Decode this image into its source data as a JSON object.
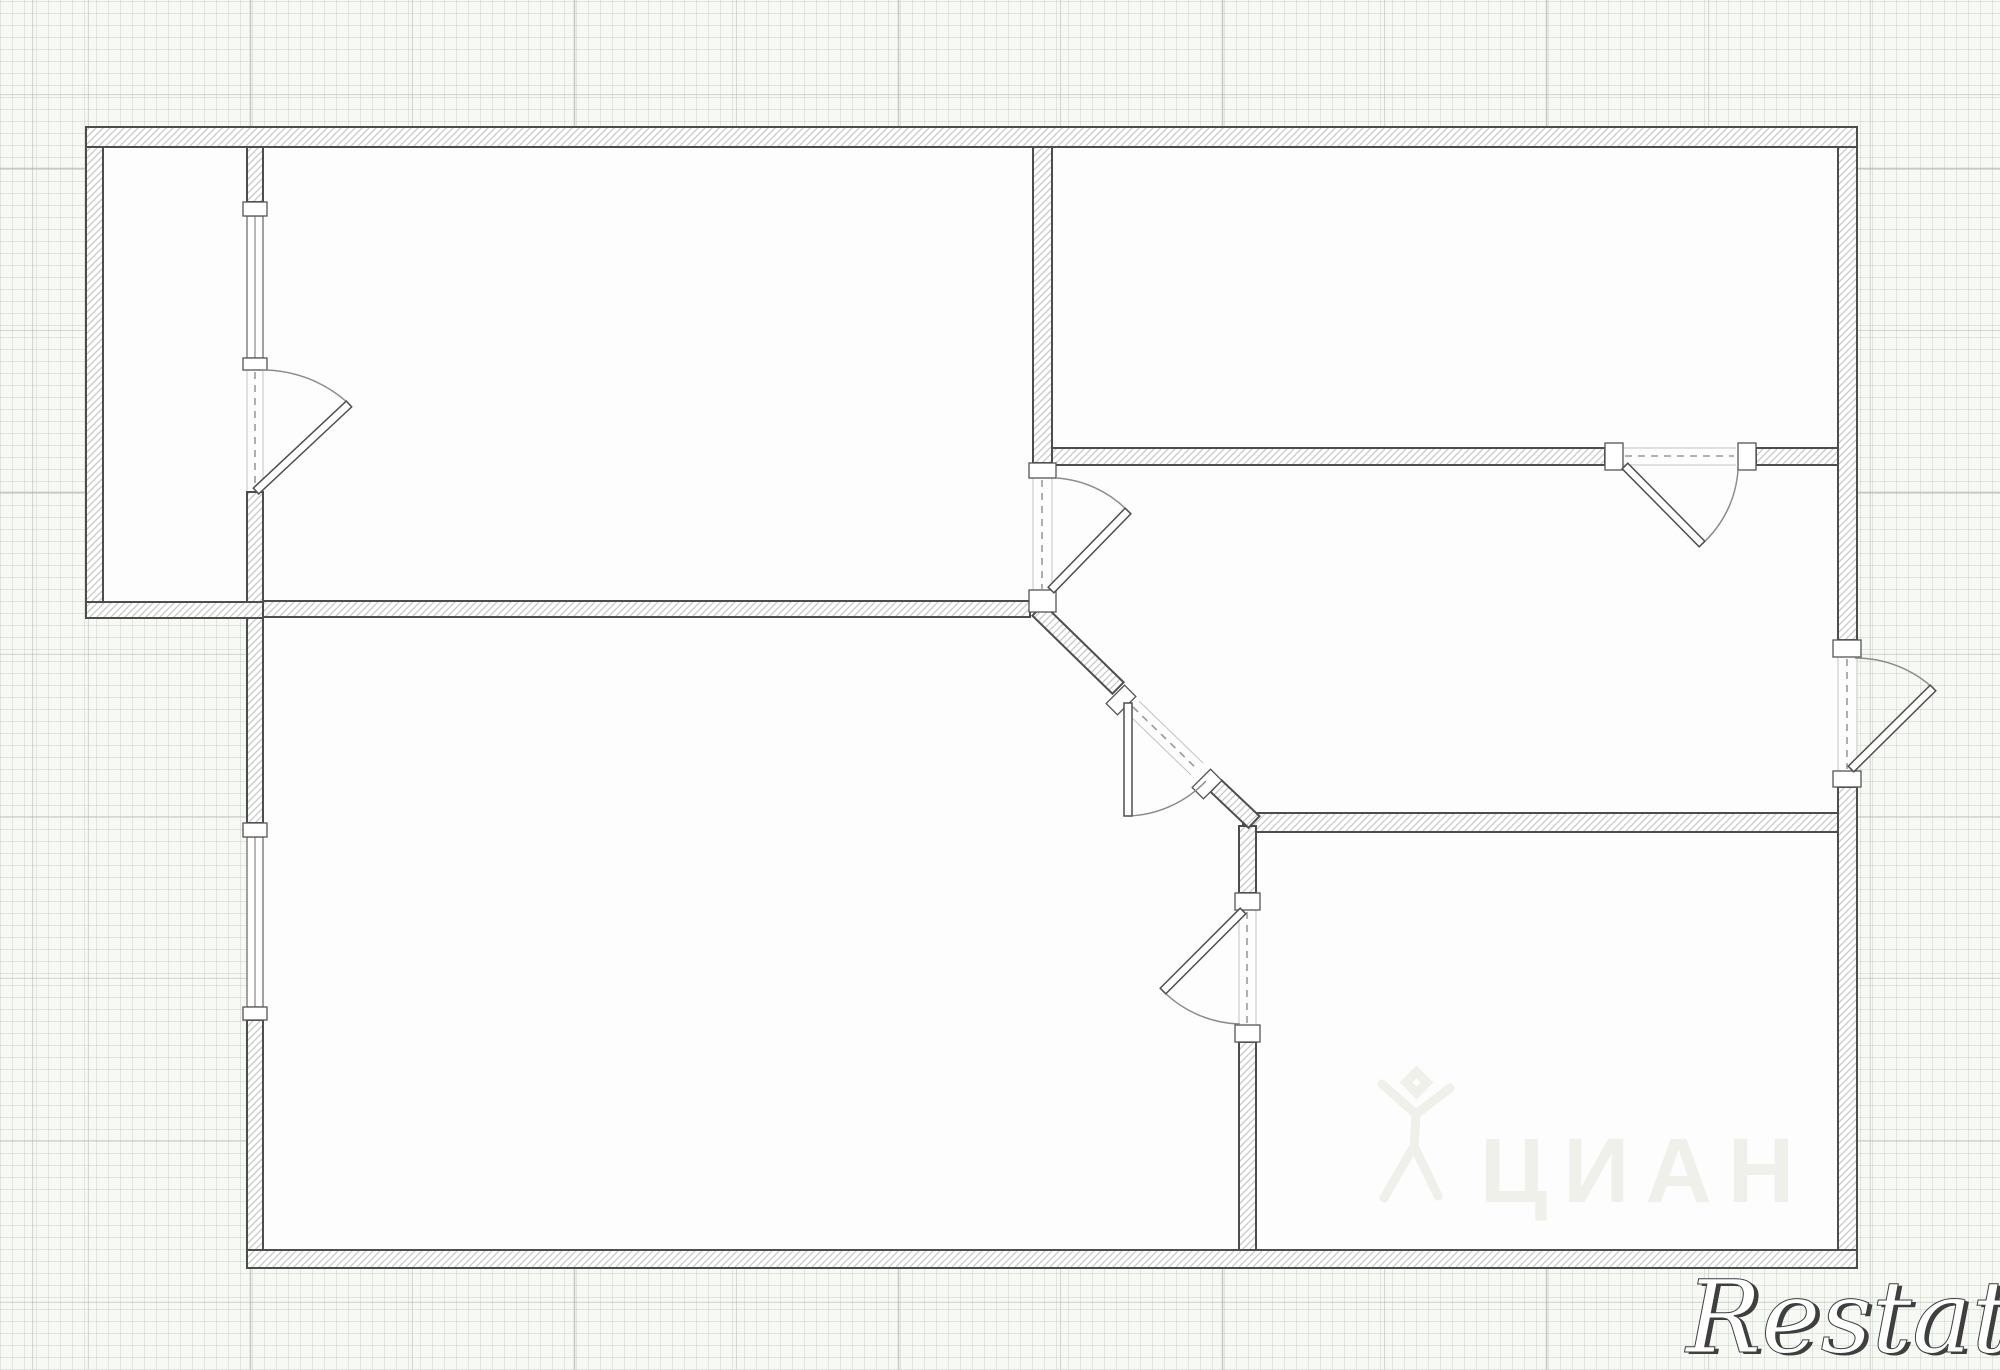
{
  "canvas": {
    "width": 2000,
    "height": 1370
  },
  "watermarks": {
    "cian_text": "ЦИАН",
    "restate_text": "Restate"
  },
  "colors": {
    "floor": "#fdfdfd",
    "wall_stroke": "#4d4d4d",
    "hatch_line": "#c9c9c9",
    "hatch_bg": "#ffffff",
    "jamb_stroke": "#555555",
    "window_stroke": "#6f6f6f",
    "opening_edge": "#c4c4c4",
    "opening_dash": "#9a9a9a",
    "door_arc": "#8c8c8c",
    "door_leaf_fill": "#ffffff",
    "door_leaf_stroke": "#4f4f4f",
    "cian_watermark": "#f0f0ea",
    "restate_fill": "#ffffff",
    "restate_outline": "#3f3f3f"
  },
  "grid": {
    "bg": "#f7f9f5",
    "minor_step": 12,
    "minor_color": "rgba(186,196,186,0.38)",
    "major_step": 162,
    "major_color": "rgba(158,164,158,0.55)",
    "major_offset_x": 88,
    "major_offset_y": 95
  },
  "floorplan": {
    "outline": [
      [
        86,
        127
      ],
      [
        1857,
        127
      ],
      [
        1857,
        1268
      ],
      [
        247,
        1268
      ],
      [
        247,
        618
      ],
      [
        86,
        618
      ]
    ],
    "walls": [
      {
        "name": "top-exterior-wall",
        "x": 86,
        "y": 127,
        "w": 1771,
        "h": 20
      },
      {
        "name": "left-upper-exterior-wall",
        "x": 86,
        "y": 147,
        "w": 17,
        "h": 455
      },
      {
        "name": "balcony-bottom-wall",
        "x": 86,
        "y": 602,
        "w": 177,
        "h": 16
      },
      {
        "name": "balcony-partition-stub",
        "x": 247,
        "y": 147,
        "w": 16,
        "h": 55
      },
      {
        "name": "balcony-partition-lower",
        "x": 247,
        "y": 492,
        "w": 16,
        "h": 110
      },
      {
        "name": "livingroom-bottom-wall",
        "x": 263,
        "y": 601,
        "w": 767,
        "h": 16
      },
      {
        "name": "center-vertical-wall",
        "x": 1033,
        "y": 147,
        "w": 19,
        "h": 316
      },
      {
        "name": "topright-bottom-wall-left",
        "x": 1052,
        "y": 448,
        "w": 553,
        "h": 17
      },
      {
        "name": "topright-bottom-wall-right",
        "x": 1756,
        "y": 448,
        "w": 82,
        "h": 17
      },
      {
        "name": "right-exterior-wall-upper",
        "x": 1838,
        "y": 147,
        "w": 19,
        "h": 493
      },
      {
        "name": "right-exterior-wall-lower",
        "x": 1838,
        "y": 787,
        "w": 19,
        "h": 463
      },
      {
        "name": "midright-bottom-wall",
        "x": 1243,
        "y": 813,
        "w": 595,
        "h": 19
      },
      {
        "name": "bottomcenter-wall-upper",
        "x": 1239,
        "y": 826,
        "w": 17,
        "h": 67
      },
      {
        "name": "bottomcenter-wall-lower",
        "x": 1239,
        "y": 1042,
        "w": 17,
        "h": 208
      },
      {
        "name": "left-lower-exterior-wall-a",
        "x": 247,
        "y": 618,
        "w": 16,
        "h": 205
      },
      {
        "name": "left-lower-exterior-wall-b",
        "x": 247,
        "y": 1020,
        "w": 16,
        "h": 230
      },
      {
        "name": "bottom-exterior-wall",
        "x": 247,
        "y": 1250,
        "w": 1610,
        "h": 18
      }
    ],
    "diag_walls": [
      {
        "name": "diagonal-wall-a",
        "x1": 1038,
        "y1": 610,
        "x2": 1118,
        "y2": 688,
        "thick": 16
      },
      {
        "name": "diagonal-wall-b",
        "x1": 1216,
        "y1": 786,
        "x2": 1254,
        "y2": 822,
        "thick": 16
      }
    ],
    "jambs": [
      {
        "x": 243,
        "y": 202,
        "w": 24,
        "h": 14,
        "angle": 0
      },
      {
        "x": 243,
        "y": 358,
        "w": 24,
        "h": 12,
        "angle": 0
      },
      {
        "x": 243,
        "y": 823,
        "w": 24,
        "h": 14,
        "angle": 0
      },
      {
        "x": 243,
        "y": 1007,
        "w": 24,
        "h": 13,
        "angle": 0
      },
      {
        "x": 1029,
        "y": 463,
        "w": 27,
        "h": 15,
        "angle": 0
      },
      {
        "x": 1029,
        "y": 590,
        "w": 27,
        "h": 22,
        "angle": 0
      },
      {
        "x": 1605,
        "y": 443,
        "w": 18,
        "h": 27,
        "angle": 0
      },
      {
        "x": 1738,
        "y": 443,
        "w": 18,
        "h": 27,
        "angle": 0
      },
      {
        "x": 1833,
        "y": 640,
        "w": 28,
        "h": 17,
        "angle": 0
      },
      {
        "x": 1833,
        "y": 771,
        "w": 28,
        "h": 16,
        "angle": 0
      },
      {
        "x": 1235,
        "y": 893,
        "w": 25,
        "h": 17,
        "angle": 0
      },
      {
        "x": 1235,
        "y": 1025,
        "w": 25,
        "h": 17,
        "angle": 0
      },
      {
        "x": 1113,
        "y": 687,
        "w": 16,
        "h": 26,
        "angle": 45
      },
      {
        "x": 1199,
        "y": 771,
        "w": 16,
        "h": 26,
        "angle": 45
      }
    ],
    "windows": [
      {
        "name": "balcony-window",
        "x": 247,
        "y": 216,
        "w": 16,
        "h": 142
      },
      {
        "name": "bottomleft-window",
        "x": 247,
        "y": 837,
        "w": 16,
        "h": 170
      }
    ],
    "open_edges": [
      [
        247,
        370,
        247,
        491
      ],
      [
        263,
        370,
        263,
        491
      ],
      [
        1033,
        478,
        1033,
        590
      ],
      [
        1052,
        478,
        1052,
        590
      ],
      [
        1623,
        448,
        1736,
        448
      ],
      [
        1623,
        465,
        1736,
        465
      ],
      [
        1838,
        657,
        1838,
        771
      ],
      [
        1857,
        657,
        1857,
        771
      ],
      [
        1239,
        910,
        1239,
        1025
      ],
      [
        1256,
        910,
        1256,
        1025
      ],
      [
        1127,
        713,
        1191,
        775
      ],
      [
        1139,
        701,
        1203,
        763
      ]
    ],
    "door_openings": [
      [
        255,
        372,
        255,
        489
      ],
      [
        1042,
        480,
        1042,
        589
      ],
      [
        1625,
        456,
        1734,
        456
      ],
      [
        1847,
        659,
        1847,
        769
      ],
      [
        1247,
        912,
        1247,
        1023
      ],
      [
        1133,
        707,
        1197,
        769
      ]
    ],
    "doors": [
      {
        "name": "balcony-door",
        "hinge": [
          256,
          491
        ],
        "tip": [
          349,
          404
        ],
        "arc_start": [
          262,
          370
        ]
      },
      {
        "name": "livingroom-hall-door",
        "hinge": [
          1051,
          590
        ],
        "tip": [
          1128,
          511
        ],
        "arc_start": [
          1056,
          478
        ]
      },
      {
        "name": "topright-room-door",
        "hinge": [
          1625,
          466
        ],
        "tip": [
          1702,
          544
        ],
        "arc_start": [
          1738,
          470
        ]
      },
      {
        "name": "right-exterior-door",
        "hinge": [
          1851,
          769
        ],
        "tip": [
          1933,
          688
        ],
        "arc_start": [
          1855,
          658
        ]
      },
      {
        "name": "bottomleft-room-door",
        "hinge": [
          1243,
          911
        ],
        "tip": [
          1163,
          991
        ],
        "arc_start": [
          1240,
          1024
        ]
      },
      {
        "name": "diagonal-hall-door",
        "hinge": [
          1128,
          703
        ],
        "tip": [
          1128,
          816
        ],
        "arc_start": [
          1206,
          781
        ]
      }
    ]
  }
}
